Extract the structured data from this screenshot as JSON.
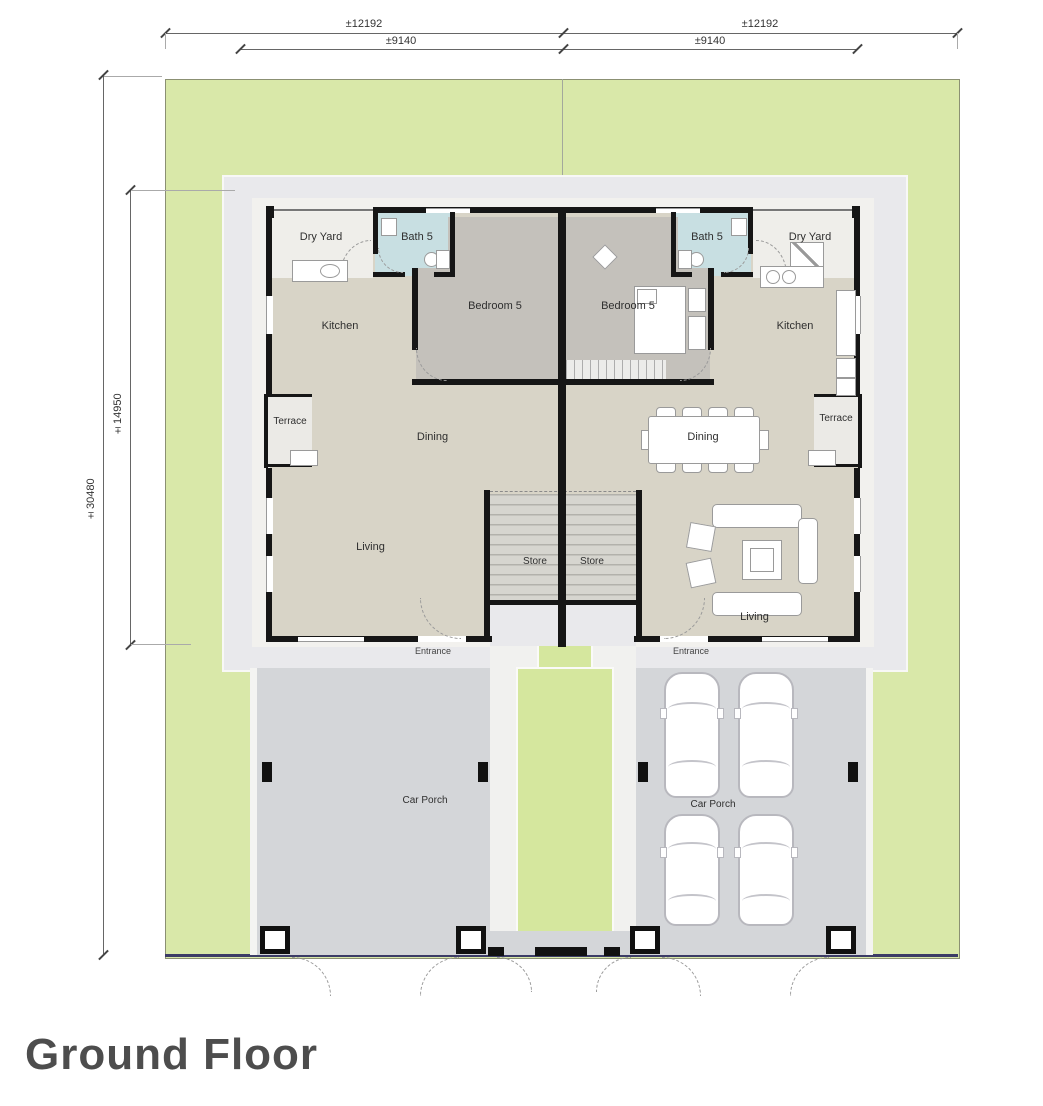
{
  "title": "Ground Floor",
  "dimensions": {
    "top_outer_left": "±12192",
    "top_outer_right": "±12192",
    "top_inner_left": "±9140",
    "top_inner_right": "±9140",
    "side_outer": "±30480",
    "side_inner": "±14950"
  },
  "units": {
    "left": {
      "dry_yard": "Dry Yard",
      "bath": "Bath 5",
      "bedroom": "Bedroom 5",
      "kitchen": "Kitchen",
      "terrace": "Terrace",
      "dining": "Dining",
      "living": "Living",
      "store": "Store",
      "entrance": "Entrance",
      "car_porch": "Car Porch"
    },
    "right": {
      "dry_yard": "Dry Yard",
      "bath": "Bath 5",
      "bedroom": "Bedroom 5",
      "kitchen": "Kitchen",
      "terrace": "Terrace",
      "dining": "Dining",
      "living": "Living",
      "store": "Store",
      "entrance": "Entrance",
      "car_porch": "Car Porch"
    }
  },
  "colors": {
    "lawn": "#d9e8a9",
    "apron": "#e9e9ec",
    "car_porch": "#d4d6d9",
    "floor_main": "#d8d4c7",
    "floor_bedroom": "#c4c1bb",
    "floor_bath": "#c8dfe2",
    "wall": "#161616",
    "boundary_bottom": "#3c3c66",
    "green_strip": "#d5e79e"
  }
}
